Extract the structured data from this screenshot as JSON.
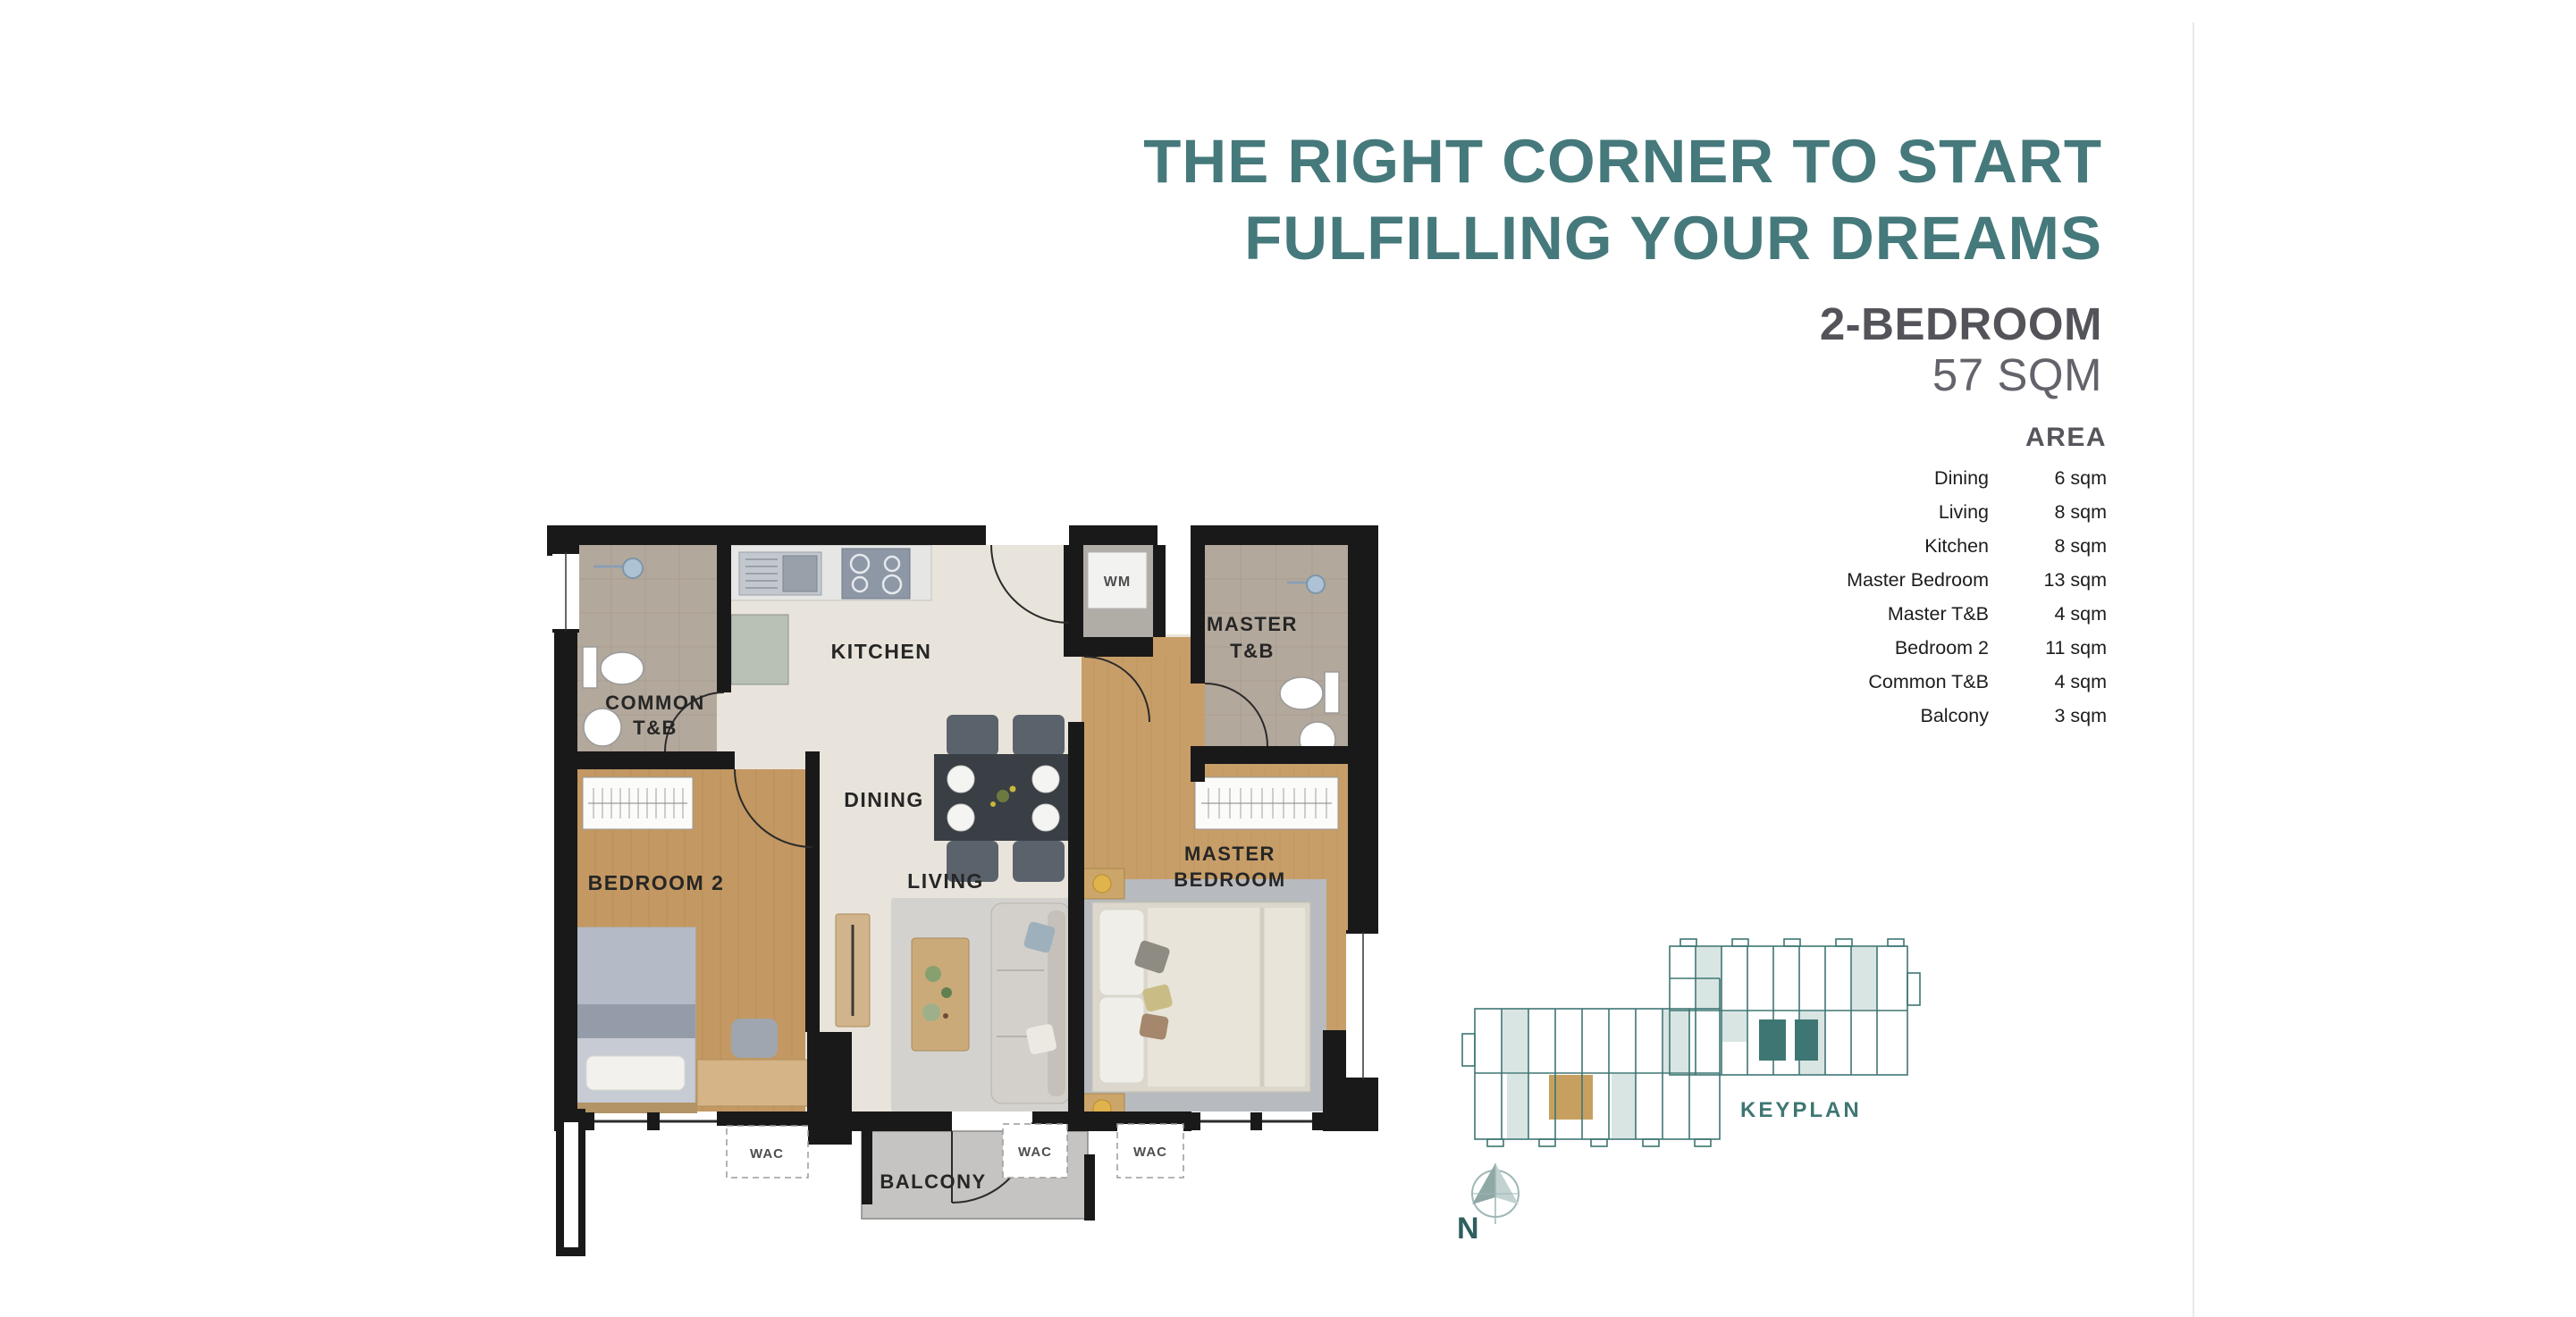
{
  "header": {
    "title_line1": "THE RIGHT CORNER TO START",
    "title_line2": "FULFILLING YOUR DREAMS",
    "unit_type": "2-BEDROOM",
    "unit_size": "57 SQM"
  },
  "area_table": {
    "heading": "AREA",
    "rows": [
      {
        "label": "Dining",
        "value": "6 sqm"
      },
      {
        "label": "Living",
        "value": "8 sqm"
      },
      {
        "label": "Kitchen",
        "value": "8 sqm"
      },
      {
        "label": "Master Bedroom",
        "value": "13 sqm"
      },
      {
        "label": "Master T&B",
        "value": "4 sqm"
      },
      {
        "label": "Bedroom 2",
        "value": "11 sqm"
      },
      {
        "label": "Common T&B",
        "value": "4 sqm"
      },
      {
        "label": "Balcony",
        "value": "3 sqm"
      }
    ]
  },
  "floor_plan": {
    "labels": {
      "kitchen": "KITCHEN",
      "common_tb_1": "COMMON",
      "common_tb_2": "T&B",
      "dining": "DINING",
      "bedroom2": "BEDROOM 2",
      "living": "LIVING",
      "master_tb_1": "MASTER",
      "master_tb_2": "T&B",
      "master_br_1": "MASTER",
      "master_br_2": "BEDROOM",
      "balcony": "BALCONY",
      "wm": "WM",
      "wac": "WAC"
    }
  },
  "keyplan": {
    "label": "KEYPLAN",
    "compass": "N"
  },
  "colors": {
    "accent_teal": "#45797b",
    "heading_gray": "#53535a",
    "keyplan_teal": "#3e7673",
    "unit_highlight": "#c7a05f",
    "wall_black": "#191919",
    "wood_floor": "#c49a67",
    "tb_floor": "#b3a89c",
    "main_floor": "#e9e4db"
  }
}
